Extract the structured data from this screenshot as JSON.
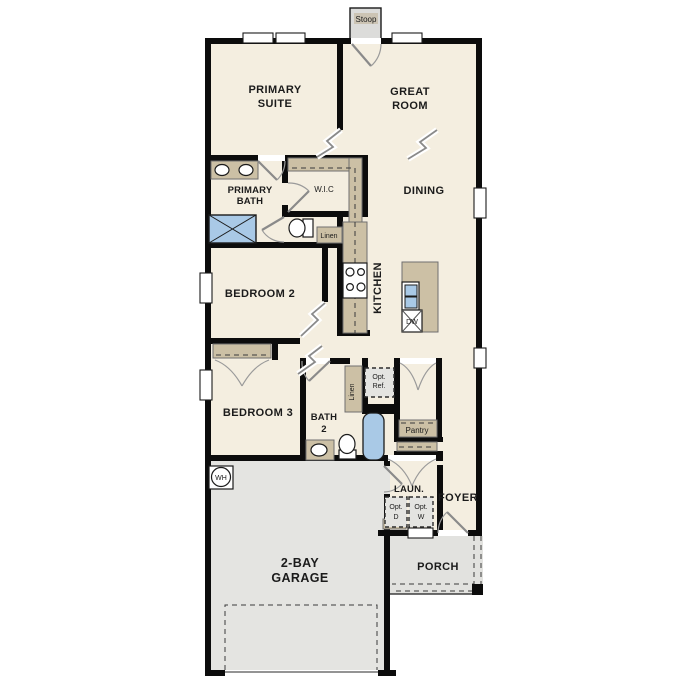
{
  "title": "single-story floor plan",
  "colors": {
    "floor_beige": "#f4eee0",
    "garage_gray": "#e4e4e1",
    "porch_gray": "#e2e2df",
    "stoop_gray": "#dcdcda",
    "cabinet_tan": "#ccc0a5",
    "fixture_blue": "#a9c9e6",
    "wall_black": "#0c0c0c"
  },
  "labels": {
    "stoop": "Stoop",
    "primary_suite_1": "PRIMARY",
    "primary_suite_2": "SUITE",
    "great_room_1": "GREAT",
    "great_room_2": "ROOM",
    "primary_bath_1": "PRIMARY",
    "primary_bath_2": "BATH",
    "wic": "W.I.C",
    "dining": "DINING",
    "linen_primary": "Linen",
    "bedroom2": "BEDROOM 2",
    "kitchen": "KITCHEN",
    "dw": "DW",
    "bedroom3": "BEDROOM 3",
    "bath2_1": "BATH",
    "bath2_2": "2",
    "linen_bath2": "Linen",
    "opt_ref_1": "Opt.",
    "opt_ref_2": "Ref.",
    "pantry": "Pantry",
    "wh": "WH",
    "laundry": "LAUN.",
    "opt_d_1": "Opt.",
    "opt_d_2": "D",
    "opt_w_1": "Opt.",
    "opt_w_2": "W",
    "foyer": "FOYER",
    "garage_1": "2-BAY",
    "garage_2": "GARAGE",
    "porch": "PORCH"
  }
}
